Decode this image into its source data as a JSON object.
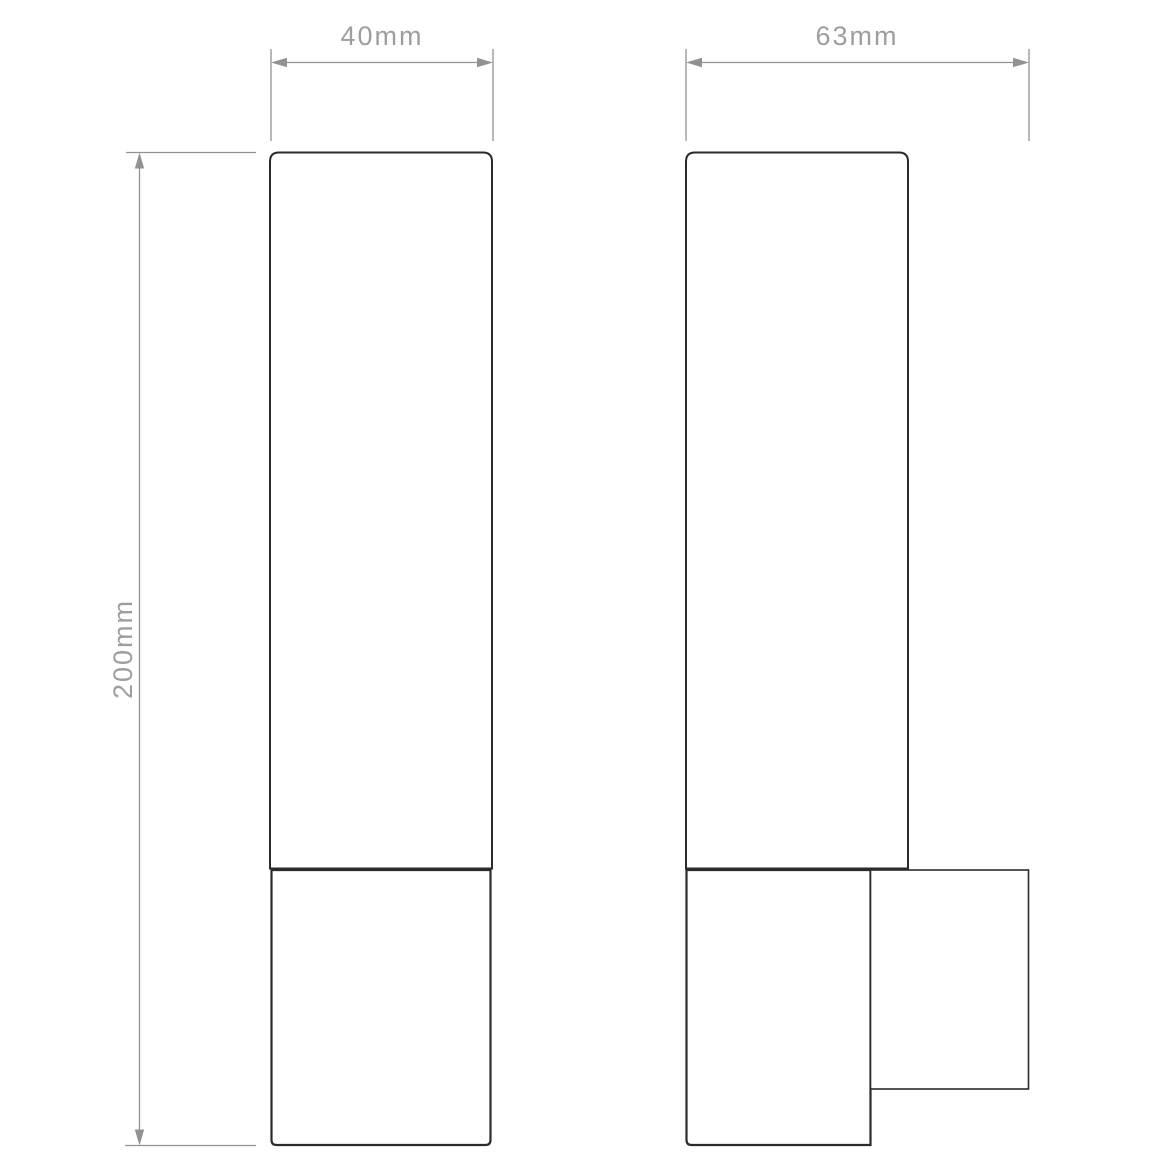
{
  "drawing": {
    "type": "technical-dimension-drawing",
    "views": {
      "front": {
        "name": "front view"
      },
      "side": {
        "name": "side view"
      }
    }
  },
  "dimensions": {
    "front_width": {
      "label": "40mm"
    },
    "side_depth": {
      "label": "63mm"
    },
    "height": {
      "label": "200mm"
    }
  },
  "colors": {
    "background": "#ffffff",
    "figure_stroke": "#2b2b2b",
    "dimension_line": "#929292",
    "dimension_text": "#9e9e9e"
  }
}
